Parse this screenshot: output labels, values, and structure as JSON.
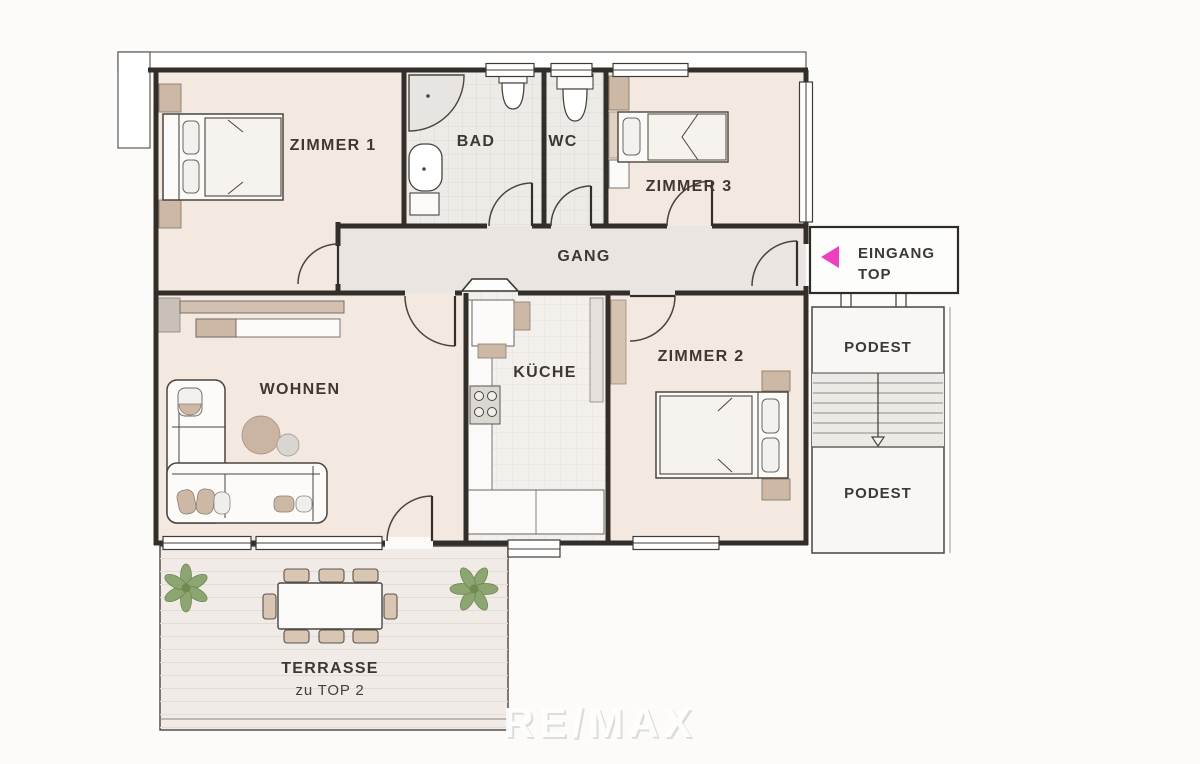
{
  "plan": {
    "rooms": {
      "zimmer1": "ZIMMER 1",
      "bad": "BAD",
      "wc": "WC",
      "zimmer3": "ZIMMER 3",
      "gang": "GANG",
      "wohnen": "WOHNEN",
      "kueche": "KÜCHE",
      "zimmer2": "ZIMMER 2",
      "podest_upper": "PODEST",
      "podest_lower": "PODEST",
      "terrasse_line1": "TERRASSE",
      "terrasse_line2": "zu TOP 2"
    },
    "entrance": {
      "label_line1": "EINGANG",
      "label_line2": "TOP",
      "arrow_direction": "left",
      "arrow_color": "#ee3fbf"
    },
    "watermark": "RE/MAX",
    "colors": {
      "wall": "#332e2a",
      "room_fill": "#f4e9e1",
      "corridor_fill": "#eae5e1",
      "wet_room_fill": "#edebe8",
      "kitchen_fill": "#f2efec",
      "terrace_fill": "#f0ebe6",
      "stair_fill": "#eceae7",
      "landing_fill": "#f8f7f5",
      "accent_tan": "#cdb8a5",
      "accent_tan_light": "#e0d2c3",
      "furniture_white": "#fbfaf8"
    }
  }
}
